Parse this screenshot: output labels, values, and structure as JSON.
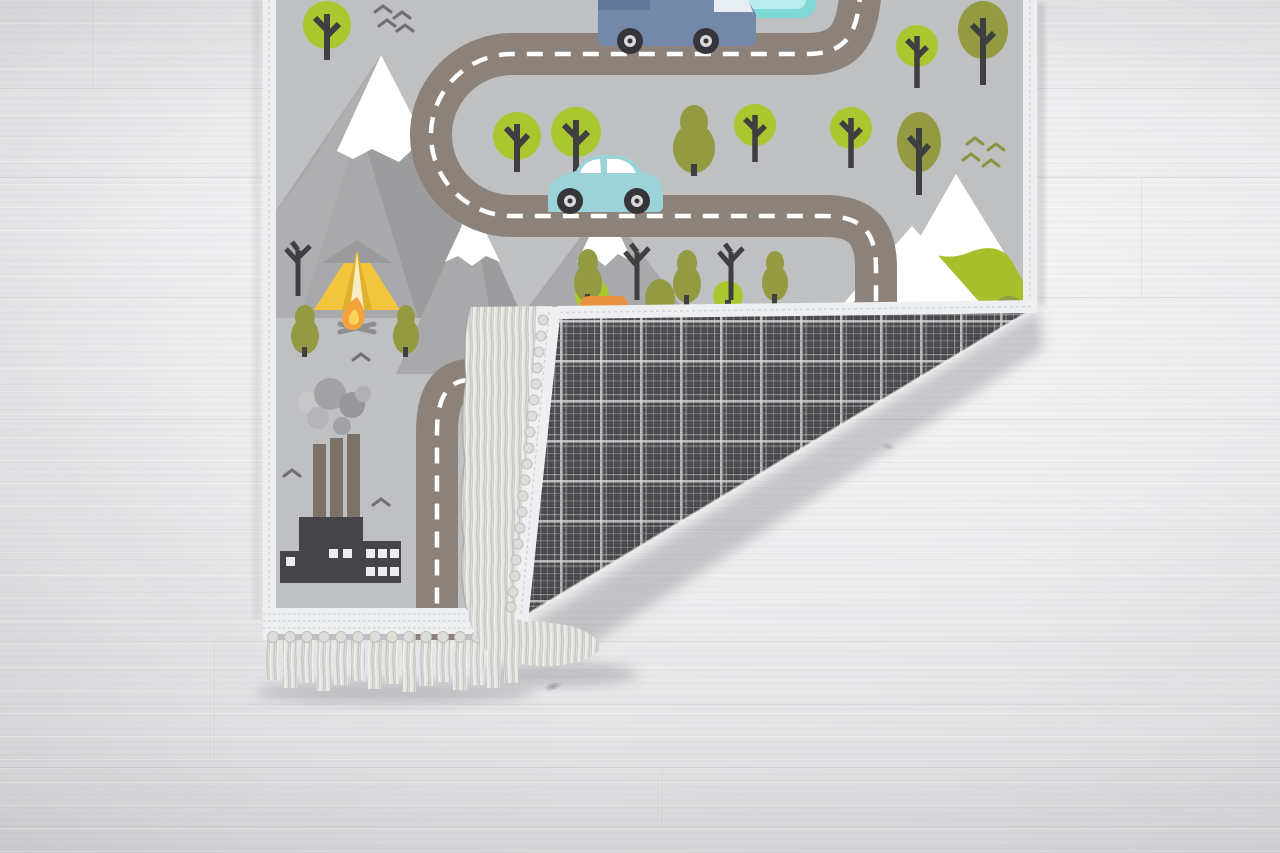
{
  "scene": {
    "type": "product photo",
    "subject": "children's road play rug with folded corner revealing plaid backing and fringed edges, lying on a whitewashed wood plank floor",
    "text_visible": "none"
  },
  "floor": {
    "material": "whitewashed wood planks, horizontal grain",
    "details": [
      "plank seams",
      "small dark knots",
      "soft shadows under rug edges"
    ]
  },
  "rug": {
    "style": "kids road play mat",
    "state": "bottom-right corner folded over, showing reverse side",
    "back": "dark grey tartan plaid weave with light grid lines",
    "edges": "white bound edges with off-white knotted fringe tassels",
    "front_elements": [
      "winding grey road with white dashed center line",
      "vertical road near factory",
      "blue van (cropped at top edge)",
      "teal beetle car",
      "orange car partially hidden under fold",
      "teal pond at top edge",
      "snow-capped grey mountains",
      "snow-capped green mountains",
      "round bright-green trees",
      "olive round trees",
      "olive pine trees",
      "bare dead trees",
      "yellow camping tent with grey roof",
      "campfire with crossed logs",
      "dark factory with three smokestacks and smoke puffs",
      "flying bird chevrons (grey and olive)"
    ],
    "counts": {
      "green_round_trees": 8,
      "olive_trees": 4,
      "pine_trees": 6,
      "dead_trees": 3,
      "mountains": 5,
      "vehicles": 3,
      "bird_flocks": 3
    }
  },
  "colors": {
    "rug-bg": "#bfc0c2",
    "road": "#8c8279",
    "road-dash": "#ffffff",
    "binding": "#edeff1",
    "stitch": "#cfd2d5",
    "fringe": "#e3e2de",
    "fringe-shade": "#c7c6c2",
    "fringe-light": "#f4f3ef",
    "plaid-base": "#4d4d50",
    "plaid-bright": "#e2e2e4",
    "plaid-mid": "#c4c4c7",
    "plaid-dim": "#9a9a9e",
    "tree-green": "#a9c72e",
    "tree-olive": "#949a41",
    "trunk": "#3f3f42",
    "mountain-grey": "#a9a9ab",
    "mountain-grey-dark": "#9c9c9e",
    "mountain-grey-light": "#b4b4b6",
    "snow-white": "#ffffff",
    "mountain-green": "#a6bf2b",
    "tent-yellow": "#f2c53d",
    "tent-roof": "#9b9b9d",
    "tent-fold": "#dfb12f",
    "fire-orange": "#f2a33c",
    "fire-yellow": "#f8d05a",
    "log-grey": "#8e8e90",
    "factory-dark": "#454549",
    "stack-brown": "#7d7268",
    "smoke-grey": "#a2a2a4",
    "smoke-light": "#c7c7c9",
    "window-white": "#ededef",
    "van-blue": "#7489a9",
    "van-roof": "#617699",
    "van-window": "#e8edf2",
    "car-teal": "#9cd3d8",
    "car-window": "#ffffff",
    "wheel-dark": "#35353a",
    "hub-light": "#d8d8da",
    "pond-teal": "#7fd8d8",
    "pond-inner": "#b9ecec",
    "car-orange": "#e8913f",
    "bird-grey": "#707074",
    "bird-olive": "#8b9340"
  }
}
